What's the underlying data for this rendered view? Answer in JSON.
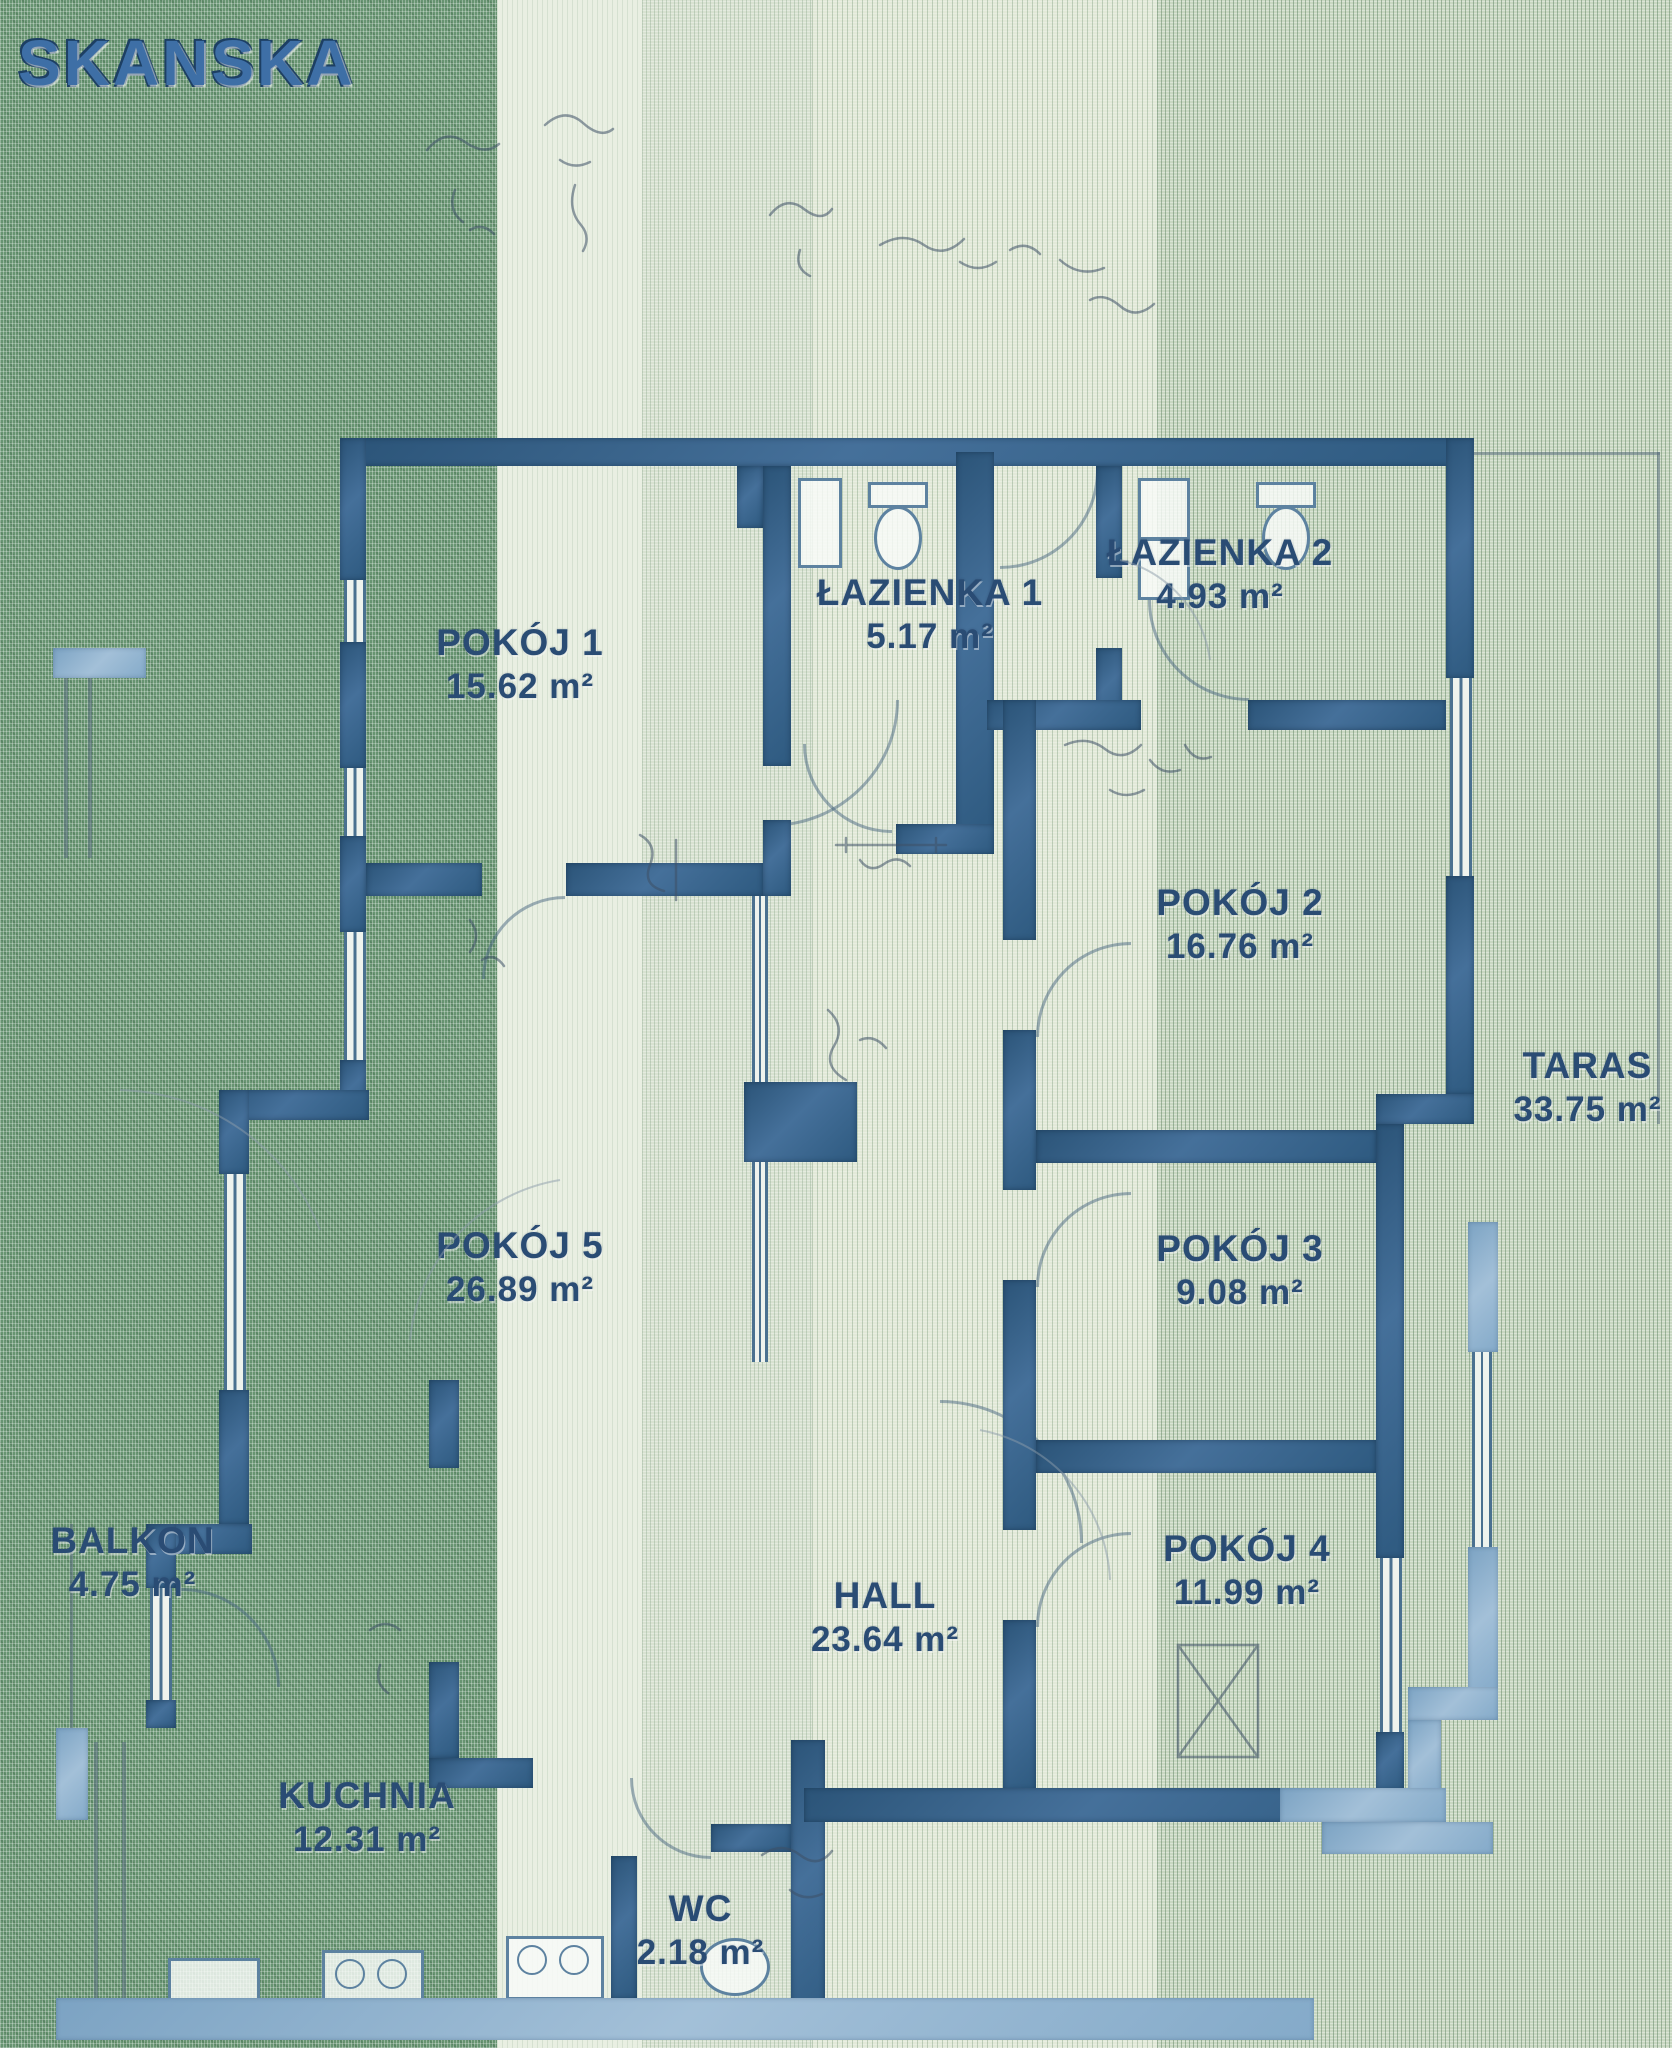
{
  "logo": {
    "text": "SKANSKA"
  },
  "plan": {
    "rooms": [
      {
        "id": "pokoj-1",
        "name": "POKÓJ 1",
        "area_label": "15.62 m²"
      },
      {
        "id": "lazienka-1",
        "name": "ŁAZIENKA 1",
        "area_label": "5.17 m²"
      },
      {
        "id": "lazienka-2",
        "name": "ŁAZIENKA 2",
        "area_label": "4.93 m²"
      },
      {
        "id": "pokoj-2",
        "name": "POKÓJ 2",
        "area_label": "16.76 m²"
      },
      {
        "id": "taras",
        "name": "TARAS",
        "area_label": "33.75 m²"
      },
      {
        "id": "pokoj-5",
        "name": "POKÓJ 5",
        "area_label": "26.89 m²"
      },
      {
        "id": "pokoj-3",
        "name": "POKÓJ 3",
        "area_label": "9.08 m²"
      },
      {
        "id": "balkon",
        "name": "BALKON",
        "area_label": "4.75 m²"
      },
      {
        "id": "hall",
        "name": "HALL",
        "area_label": "23.64 m²"
      },
      {
        "id": "pokoj-4",
        "name": "POKÓJ 4",
        "area_label": "11.99 m²"
      },
      {
        "id": "kuchnia",
        "name": "KUCHNIA",
        "area_label": "12.31 m²"
      },
      {
        "id": "wc",
        "name": "WC",
        "area_label": "2.18 m²"
      }
    ],
    "colors": {
      "wall_dark": "#2f5a80",
      "wall_light": "#87accb",
      "label_text": "#2a4c74",
      "logo_blue": "#3e6fa6"
    }
  }
}
